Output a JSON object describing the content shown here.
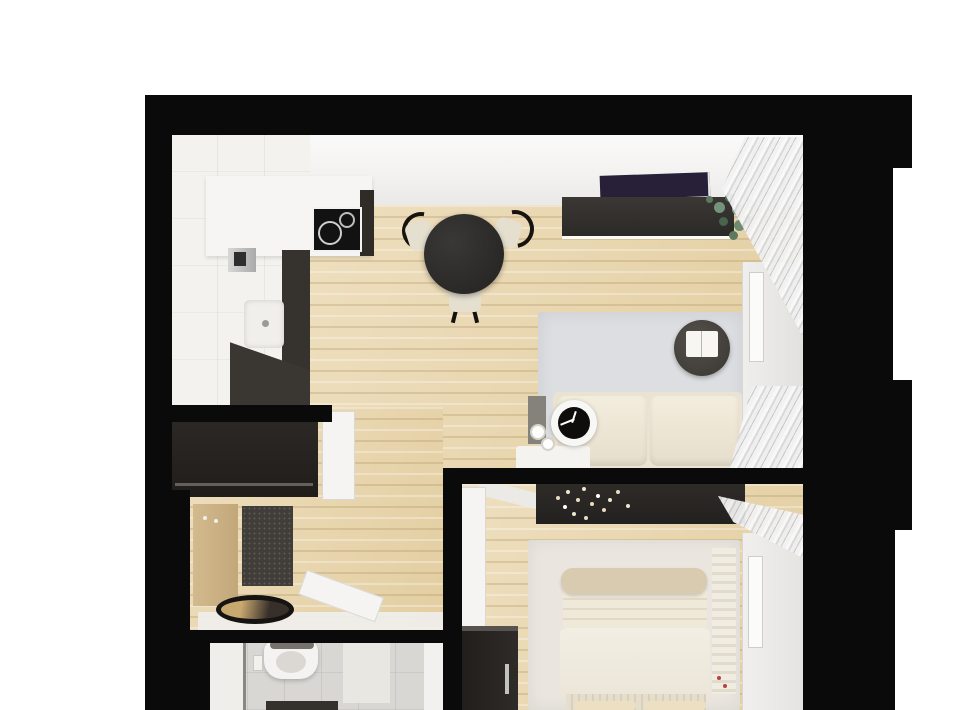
{
  "scene": {
    "type": "apartment-floor-plan-3d-render",
    "view": "top-down orthographic render, photorealistic, no text or annotations",
    "canvas_px": {
      "width": 960,
      "height": 710
    },
    "page_background": "#ffffff",
    "wall_color": "#0a0a0a",
    "cropped_edges": "bottom of apartment is cut off at image edge"
  },
  "labels": {
    "stage": "3D rendered apartment floor plan (top-down view)",
    "walls": "Black structural walls",
    "kitchen": "Kitchen with white L-shaped counter, cooktop and sink",
    "living": "Open-plan living / dining room with light wood floor",
    "hallway": "Entry hallway with wardrobe, coat panel, doormat and mirror",
    "bathroom": "Bathroom with wall-hung toilet and gray tile floor",
    "bedroom": "Bedroom with double bed, dresser and wardrobe",
    "dining_table": "Round black dining table with three cream chairs",
    "tv_sideboard": "Dark TV sideboard with plant, purple TV panel above",
    "sofa": "Cream two-seat sofa",
    "coffee_table": "Round dark coffee table with open book",
    "rug_living": "Light gray area rug",
    "clock": "Round table clock with black face",
    "wardrobe_living": "White wardrobe with mirror, living room",
    "curtains": "Light gray curtains at windows",
    "bed": "Double bed with cream duvet, folded blanket and pillows",
    "bed_console": "Dark shelf above bed head with white flower decor",
    "dresser": "Dark bedroom dresser with metal handle",
    "wardrobe_bedroom": "White wardrobe with mirror, bedroom",
    "rug_bedroom": "Light bedroom rug",
    "hall_wardrobe": "Dark hallway wardrobe",
    "coat_panel": "Wooden coat panel with hooks",
    "door_mat": "Dark gray speckled doormat",
    "floor_mirror": "Oval floor mirror / tray",
    "toilet": "White wall-hung toilet with flush plate",
    "cooktop": "Black induction cooktop with burner rings",
    "sink": "White kitchen sink with faucet"
  },
  "rooms": [
    {
      "id": "kitchen",
      "floor": "white tile",
      "furniture": [
        "counter",
        "cooktop",
        "sink",
        "faucet",
        "dark cabinet fronts"
      ]
    },
    {
      "id": "living-dining",
      "floor": "light wood planks",
      "furniture": [
        "dining table",
        "3 chairs",
        "tv sideboard",
        "tv",
        "plant",
        "rug",
        "coffee table",
        "book",
        "sofa",
        "side table",
        "clock",
        "cups",
        "white wardrobe",
        "mirror",
        "curtains"
      ]
    },
    {
      "id": "hallway",
      "floor": "light wood planks",
      "furniture": [
        "dark wardrobe",
        "white door",
        "coat panel",
        "doormat",
        "oval mirror",
        "open bathroom door"
      ]
    },
    {
      "id": "bathroom",
      "floor": "gray tile",
      "furniture": [
        "toilet",
        "flush plate",
        "shower panel",
        "dark vanity edge"
      ]
    },
    {
      "id": "bedroom",
      "floor": "light wood planks",
      "furniture": [
        "bed",
        "blanket roll",
        "pillows",
        "head console with flowers",
        "rug",
        "dresser",
        "white wardrobe",
        "mirror",
        "curtains",
        "open door",
        "striped throw"
      ]
    }
  ],
  "colors": {
    "wood_floor": "#e8d4a9",
    "kitchen_tile": "#f3f2ef",
    "bath_tile": "#d9d7d3",
    "ceiling_band": "#f3f2f0",
    "dark_furniture": "#2a2724",
    "tv_screen_purple": "#281f38",
    "sideboard": "#34302c",
    "sofa_cream": "#ece5d5",
    "rug_living_gray": "#dcdee1",
    "rug_bedroom": "#eae6df",
    "bed_duvet": "#f0ebdf",
    "blanket_roll": "#d8cbb0",
    "pillow": "#ecdfc2",
    "chair_cream": "#e5dfcf",
    "table_black": "#2b2927",
    "coffee_table": "#46423e",
    "doormat": "#413e3a",
    "coat_panel_wood": "#cdb285",
    "curtain_gray": "#d8d8d8",
    "mirror_white": "#fbfbfa",
    "plant_green": "#6d8c72",
    "clock_face": "#0e0d0c",
    "handle_metal": "#c2c2c0"
  }
}
